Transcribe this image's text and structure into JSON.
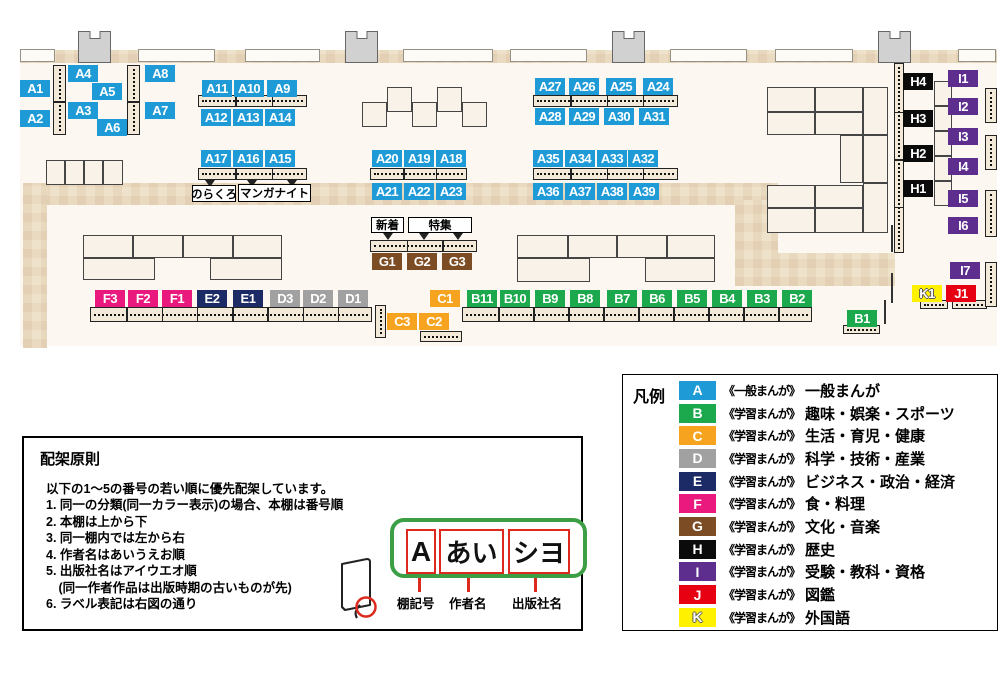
{
  "map": {
    "colors": {
      "A": "#1E9BD7",
      "B": "#1CA84D",
      "C": "#F6A41F",
      "D": "#A1A1A2",
      "E": "#1C2A66",
      "F": "#E9197D",
      "G": "#7C4D24",
      "H": "#0B0B0B",
      "I": "#5D2E8E",
      "J": "#E60012",
      "K": "#FFF100"
    },
    "shelf_labels": [
      {
        "t": "A1",
        "x": 20,
        "y": 80
      },
      {
        "t": "A2",
        "x": 20,
        "y": 110
      },
      {
        "t": "A4",
        "x": 68,
        "y": 65
      },
      {
        "t": "A5",
        "x": 92,
        "y": 83
      },
      {
        "t": "A3",
        "x": 68,
        "y": 102
      },
      {
        "t": "A6",
        "x": 97,
        "y": 119
      },
      {
        "t": "A8",
        "x": 145,
        "y": 65
      },
      {
        "t": "A7",
        "x": 145,
        "y": 102
      },
      {
        "t": "A11",
        "x": 202,
        "y": 80
      },
      {
        "t": "A10",
        "x": 234,
        "y": 80
      },
      {
        "t": "A9",
        "x": 267,
        "y": 80
      },
      {
        "t": "A12",
        "x": 201,
        "y": 109
      },
      {
        "t": "A13",
        "x": 233,
        "y": 109
      },
      {
        "t": "A14",
        "x": 265,
        "y": 109
      },
      {
        "t": "A17",
        "x": 201,
        "y": 150
      },
      {
        "t": "A16",
        "x": 233,
        "y": 150
      },
      {
        "t": "A15",
        "x": 265,
        "y": 150
      },
      {
        "t": "A20",
        "x": 372,
        "y": 150
      },
      {
        "t": "A19",
        "x": 404,
        "y": 150
      },
      {
        "t": "A18",
        "x": 436,
        "y": 150
      },
      {
        "t": "A21",
        "x": 372,
        "y": 183
      },
      {
        "t": "A22",
        "x": 404,
        "y": 183
      },
      {
        "t": "A23",
        "x": 436,
        "y": 183
      },
      {
        "t": "A27",
        "x": 535,
        "y": 78
      },
      {
        "t": "A26",
        "x": 569,
        "y": 78
      },
      {
        "t": "A25",
        "x": 606,
        "y": 78
      },
      {
        "t": "A24",
        "x": 643,
        "y": 78
      },
      {
        "t": "A28",
        "x": 535,
        "y": 108
      },
      {
        "t": "A29",
        "x": 569,
        "y": 108
      },
      {
        "t": "A30",
        "x": 604,
        "y": 108
      },
      {
        "t": "A31",
        "x": 639,
        "y": 108
      },
      {
        "t": "A35",
        "x": 533,
        "y": 150
      },
      {
        "t": "A34",
        "x": 565,
        "y": 150
      },
      {
        "t": "A33",
        "x": 597,
        "y": 150
      },
      {
        "t": "A32",
        "x": 628,
        "y": 150
      },
      {
        "t": "A36",
        "x": 533,
        "y": 183
      },
      {
        "t": "A37",
        "x": 565,
        "y": 183
      },
      {
        "t": "A38",
        "x": 597,
        "y": 183
      },
      {
        "t": "A39",
        "x": 629,
        "y": 183
      },
      {
        "t": "G1",
        "x": 372,
        "y": 253
      },
      {
        "t": "G2",
        "x": 407,
        "y": 253
      },
      {
        "t": "G3",
        "x": 442,
        "y": 253
      },
      {
        "t": "F3",
        "x": 95,
        "y": 290
      },
      {
        "t": "F2",
        "x": 128,
        "y": 290
      },
      {
        "t": "F1",
        "x": 162,
        "y": 290
      },
      {
        "t": "E2",
        "x": 197,
        "y": 290
      },
      {
        "t": "E1",
        "x": 233,
        "y": 290
      },
      {
        "t": "D3",
        "x": 270,
        "y": 290
      },
      {
        "t": "D2",
        "x": 303,
        "y": 290
      },
      {
        "t": "D1",
        "x": 338,
        "y": 290
      },
      {
        "t": "C1",
        "x": 430,
        "y": 290
      },
      {
        "t": "C3",
        "x": 387,
        "y": 313
      },
      {
        "t": "C2",
        "x": 419,
        "y": 313
      },
      {
        "t": "B11",
        "x": 467,
        "y": 290
      },
      {
        "t": "B10",
        "x": 500,
        "y": 290
      },
      {
        "t": "B9",
        "x": 535,
        "y": 290
      },
      {
        "t": "B8",
        "x": 570,
        "y": 290
      },
      {
        "t": "B7",
        "x": 607,
        "y": 290
      },
      {
        "t": "B6",
        "x": 642,
        "y": 290
      },
      {
        "t": "B5",
        "x": 677,
        "y": 290
      },
      {
        "t": "B4",
        "x": 712,
        "y": 290
      },
      {
        "t": "B3",
        "x": 747,
        "y": 290
      },
      {
        "t": "B2",
        "x": 782,
        "y": 290
      },
      {
        "t": "B1",
        "x": 847,
        "y": 310
      },
      {
        "t": "H4",
        "x": 903,
        "y": 73
      },
      {
        "t": "H3",
        "x": 903,
        "y": 110
      },
      {
        "t": "H2",
        "x": 903,
        "y": 145
      },
      {
        "t": "H1",
        "x": 903,
        "y": 180
      },
      {
        "t": "I1",
        "x": 948,
        "y": 70
      },
      {
        "t": "I2",
        "x": 948,
        "y": 98
      },
      {
        "t": "I3",
        "x": 948,
        "y": 128
      },
      {
        "t": "I4",
        "x": 948,
        "y": 158
      },
      {
        "t": "I5",
        "x": 948,
        "y": 190
      },
      {
        "t": "I6",
        "x": 948,
        "y": 217
      },
      {
        "t": "I7",
        "x": 950,
        "y": 262
      },
      {
        "t": "K1",
        "x": 912,
        "y": 285
      },
      {
        "t": "J1",
        "x": 946,
        "y": 285
      }
    ],
    "note_boxes": [
      {
        "text": "のらくろ",
        "x": 192,
        "y": 185,
        "w": 44,
        "h": 17
      },
      {
        "text": "マンガナイト",
        "x": 238,
        "y": 184,
        "w": 73,
        "h": 18
      },
      {
        "text": "新着",
        "x": 371,
        "y": 217,
        "w": 33,
        "h": 16
      },
      {
        "text": "特集",
        "x": 408,
        "y": 217,
        "w": 64,
        "h": 16
      }
    ]
  },
  "legend": {
    "title": "凡例",
    "items": [
      {
        "key": "A",
        "type": "《一般まんが》",
        "category": "一般まんが",
        "color": "#1E9BD7",
        "outline": false
      },
      {
        "key": "B",
        "type": "《学習まんが》",
        "category": "趣味・娯楽・スポーツ",
        "color": "#1CA84D",
        "outline": false
      },
      {
        "key": "C",
        "type": "《学習まんが》",
        "category": "生活・育児・健康",
        "color": "#F6A41F",
        "outline": false
      },
      {
        "key": "D",
        "type": "《学習まんが》",
        "category": "科学・技術・産業",
        "color": "#A1A1A2",
        "outline": false
      },
      {
        "key": "E",
        "type": "《学習まんが》",
        "category": "ビジネス・政治・経済",
        "color": "#1C2A66",
        "outline": false
      },
      {
        "key": "F",
        "type": "《学習まんが》",
        "category": "食・料理",
        "color": "#E9197D",
        "outline": false
      },
      {
        "key": "G",
        "type": "《学習まんが》",
        "category": "文化・音楽",
        "color": "#7C4D24",
        "outline": false
      },
      {
        "key": "H",
        "type": "《学習まんが》",
        "category": "歴史",
        "color": "#0B0B0B",
        "outline": false
      },
      {
        "key": "I",
        "type": "《学習まんが》",
        "category": "受験・教科・資格",
        "color": "#5D2E8E",
        "outline": false
      },
      {
        "key": "J",
        "type": "《学習まんが》",
        "category": "図鑑",
        "color": "#E60012",
        "outline": false
      },
      {
        "key": "K",
        "type": "《学習まんが》",
        "category": "外国語",
        "color": "#FFF100",
        "outline": true
      }
    ]
  },
  "principles": {
    "title": "配架原則",
    "intro": "以下の1〜5の番号の若い順に優先配架しています。",
    "items": [
      "1. 同一の分類(同一カラー表示)の場合、本棚は番号順",
      "2. 本棚は上から下",
      "3. 同一棚内では左から右",
      "4. 作者名はあいうえお順",
      "5. 出版社名はアイウエオ順\n　(同一作者作品は出版時期の古いものが先)",
      "6. ラベル表記は右図の通り"
    ],
    "label_example": {
      "fields": [
        {
          "value": "A",
          "caption": "棚記号"
        },
        {
          "value": "あい",
          "caption": "作者名"
        },
        {
          "value": "シヨ",
          "caption": "出版社名"
        }
      ]
    }
  }
}
